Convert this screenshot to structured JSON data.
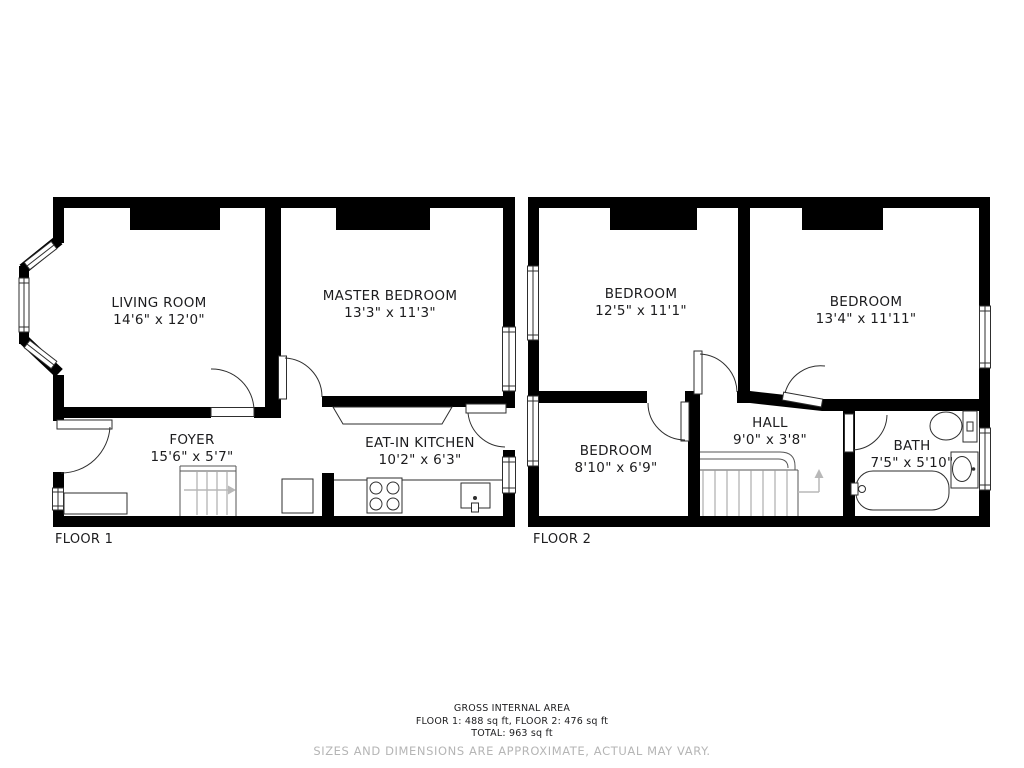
{
  "floor1": {
    "label": "FLOOR 1",
    "living": {
      "name": "LIVING ROOM",
      "dims": "14'6\" x 12'0\""
    },
    "master": {
      "name": "MASTER BEDROOM",
      "dims": "13'3\" x 11'3\""
    },
    "foyer": {
      "name": "FOYER",
      "dims": "15'6\" x 5'7\""
    },
    "kitchen": {
      "name": "EAT-IN KITCHEN",
      "dims": "10'2\" x 6'3\""
    }
  },
  "floor2": {
    "label": "FLOOR 2",
    "bedroom_left": {
      "name": "BEDROOM",
      "dims": "12'5\" x 11'1\""
    },
    "bedroom_right": {
      "name": "BEDROOM",
      "dims": "13'4\" x 11'11\""
    },
    "bedroom_small": {
      "name": "BEDROOM",
      "dims": "8'10\" x 6'9\""
    },
    "hall": {
      "name": "HALL",
      "dims": "9'0\" x 3'8\""
    },
    "bath": {
      "name": "BATH",
      "dims": "7'5\" x 5'10\""
    }
  },
  "footer": {
    "title": "GROSS INTERNAL AREA",
    "areas": "FLOOR 1: 488 sq ft, FLOOR 2: 476 sq ft",
    "total": "TOTAL: 963 sq ft",
    "disclaimer": "SIZES AND DIMENSIONS ARE APPROXIMATE, ACTUAL MAY VARY."
  },
  "colors": {
    "wall": "#000000",
    "line": "#2e2e2e",
    "stair": "#9c9c9c",
    "rail": "#555555",
    "arrow": "#b8b8b8",
    "text": "#1c1c1e",
    "muted": "#b5b5b5"
  }
}
